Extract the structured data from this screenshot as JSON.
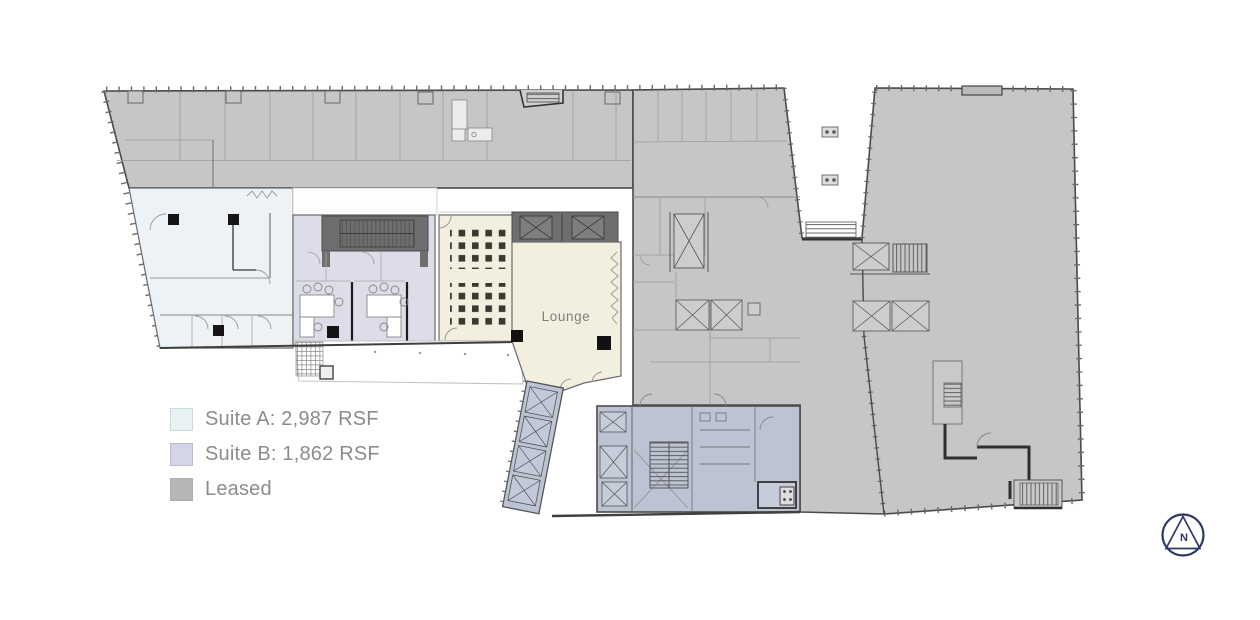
{
  "legend": {
    "text_color": "#8c8c8c",
    "items": [
      {
        "label": "Suite A: 2,987 RSF",
        "swatch_color": "#e9f3f4",
        "swatch_border": "#c6dde1"
      },
      {
        "label": "Suite B: 1,862 RSF",
        "swatch_color": "#d4d6e7",
        "swatch_border": "#b7bcd8"
      },
      {
        "label": "Leased",
        "swatch_color": "#b6b6b6",
        "swatch_border": "#aeaeae"
      }
    ]
  },
  "plan": {
    "lounge_label": "Lounge",
    "north_label": "N",
    "colors": {
      "leased_fill": "#c6c6c6",
      "suite_a_fill": "#edf2f6",
      "suite_b_fill": "#dcdde8",
      "amenity_fill": "#f2efdf",
      "core_fill": "#bcc3d3",
      "stair_block_fill": "#6e6e6e",
      "wall": "#3f3f3f",
      "north_arrow": "#2c3a63"
    }
  }
}
